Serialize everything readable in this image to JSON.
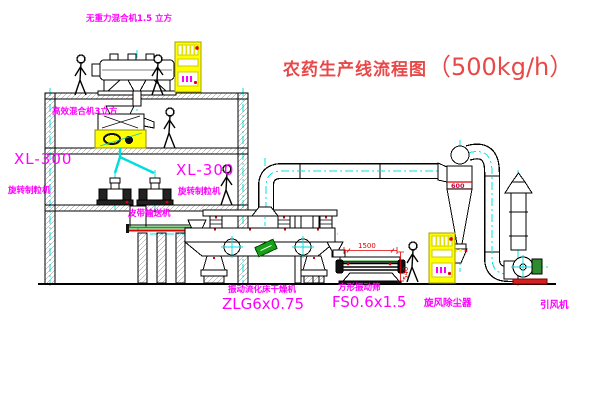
{
  "title": {
    "text": "农药生产线流程图",
    "capacity": "（500kg/h）"
  },
  "colors": {
    "label_magenta": "#ff00ff",
    "title_red": "#e84848",
    "centerline_cyan": "#00e5e5",
    "cabinet_yellow": "#ffff00",
    "accent_red": "#e00000",
    "accent_green": "#18a018"
  },
  "labels": {
    "top_mixer": "无重力混合机1.5 立方",
    "floor_mixer": "高效混合机3立方",
    "granulator_left": {
      "model": "XL-300",
      "name": "旋转制粒机"
    },
    "granulator_right": {
      "model": "XL-300",
      "name": "旋转制粒机"
    },
    "belt_conveyor": "皮带输送机",
    "dryer": {
      "name": "振动流化床干燥机",
      "model": "ZLG6x0.75"
    },
    "sieve": {
      "name": "方形振动筛",
      "model": "FS0.6x1.5"
    },
    "cyclone": "旋风除尘器",
    "fan": "引风机",
    "cyclone_band": "600",
    "dim_width": "1500",
    "dim_height": "540"
  }
}
